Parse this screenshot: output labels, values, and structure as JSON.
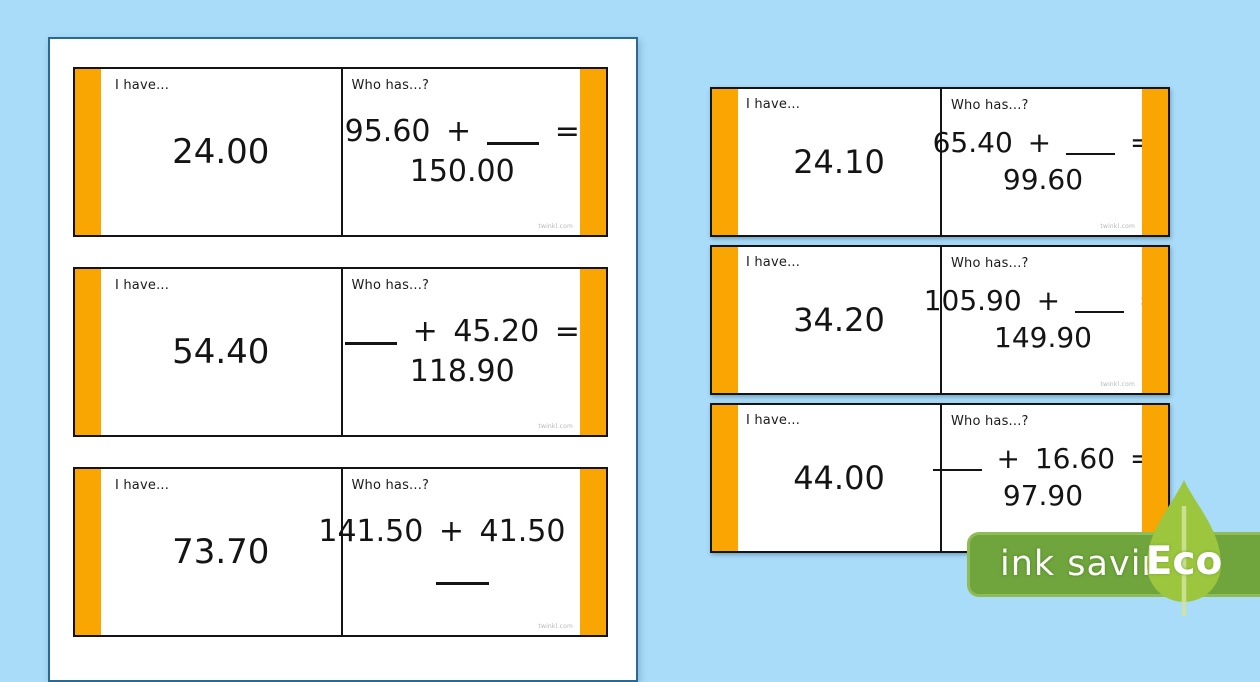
{
  "labels": {
    "i_have": "I have...",
    "who_has": "Who has...?"
  },
  "watermark": "twinkl.com",
  "cards_left": [
    {
      "have": "24.00",
      "eq1": "95.60 + ___ =",
      "eq2": "150.00"
    },
    {
      "have": "54.40",
      "eq1": "___ + 45.20 =",
      "eq2": "118.90"
    },
    {
      "have": "73.70",
      "eq1": "141.50 + 41.50 =",
      "eq2": "___"
    }
  ],
  "cards_right": [
    {
      "have": "24.10",
      "eq1": "65.40 + ___ =",
      "eq2": "99.60"
    },
    {
      "have": "34.20",
      "eq1": "105.90 + ___ =",
      "eq2": "149.90"
    },
    {
      "have": "44.00",
      "eq1": "___ + 16.60 =",
      "eq2": "97.90"
    }
  ],
  "badge": {
    "label": "ink saving",
    "eco_label": "Eco"
  },
  "colors": {
    "background": "#a8dcf8",
    "card_accent": "#f9a602",
    "badge_green": "#6fa53c",
    "badge_border": "#8fbc55",
    "leaf_green": "#9cc63e",
    "page_border": "#2a6a92"
  }
}
